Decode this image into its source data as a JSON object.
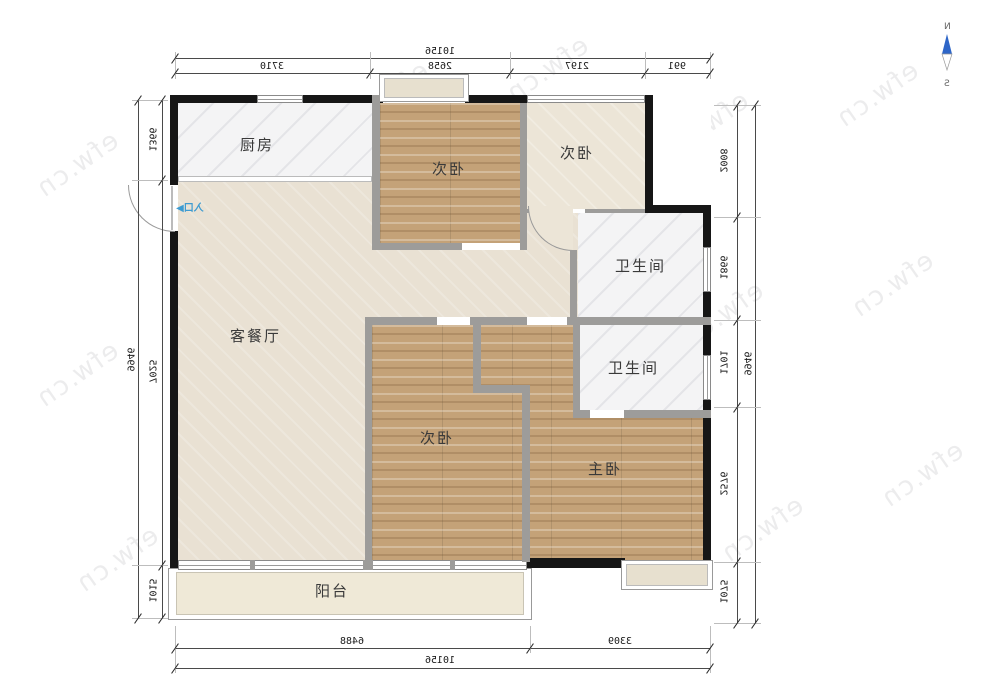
{
  "compass": {
    "north": "N",
    "south": "S"
  },
  "watermark": {
    "text": "efw.cn"
  },
  "entrance": {
    "label": "入口",
    "arrow": "▶"
  },
  "rooms": {
    "kitchen": "厨房",
    "living": "客餐厅",
    "bedroom_top": "次卧",
    "bedroom_top_right": "次卧",
    "bedroom_bottom": "次卧",
    "master": "主卧",
    "bathroom_upper": "卫生间",
    "bathroom_lower": "卫生间",
    "balcony": "阳台"
  },
  "dimensions": {
    "top_total": "10156",
    "top_segments": [
      "3710",
      "2658",
      "2197",
      "991"
    ],
    "bottom_segments": [
      "6488",
      "3309"
    ],
    "bottom_total": "10156",
    "left_total": "9946",
    "left_segments": [
      "1366",
      "7025",
      "1015"
    ],
    "right_total": "9946",
    "right_segments": [
      "2008",
      "1866",
      "1701",
      "2576",
      "1075"
    ]
  },
  "colors": {
    "wood": "#c4a278",
    "exterior_wall": "#161616",
    "interior_wall": "#9d9c9a",
    "compass_blue": "#2e66c8",
    "entrance_blue": "#3d9bd1"
  }
}
